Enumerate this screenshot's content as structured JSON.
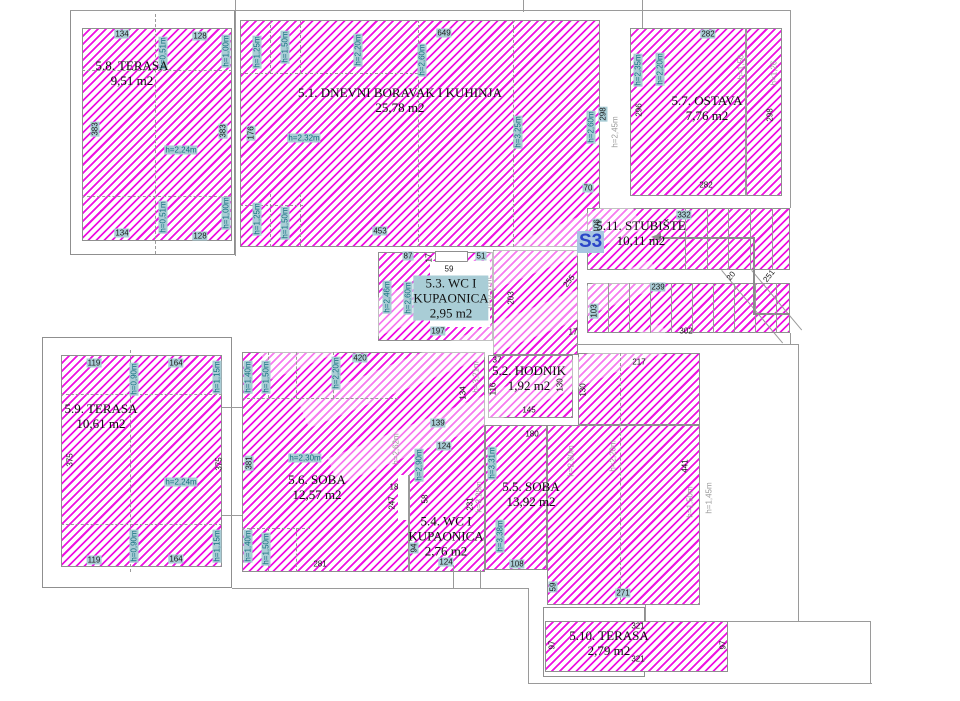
{
  "unit": {
    "label": "S3"
  },
  "palette": {
    "hatch": "#ee10e2",
    "wall": "#9a9a9a",
    "label_bg": "#a9cdd6",
    "height_text": "#15707f",
    "gray_text": "#9b9b9b",
    "s3_text": "#2b46c8",
    "s3_bg": "#a8c6e2"
  },
  "rooms": [
    {
      "lines": [
        "5.8. TERASA",
        "9,51 m2"
      ],
      "cx": 132,
      "cy": 73
    },
    {
      "lines": [
        "5.1. DNEVNI BORAVAK I KUHINJA",
        "25,78 m2"
      ],
      "cx": 400,
      "cy": 100
    },
    {
      "lines": [
        "5.7. OSTAVA",
        "7,76 m2"
      ],
      "cx": 707,
      "cy": 108
    },
    {
      "lines": [
        "5.11. STUBIŠTE",
        "10,11 m2"
      ],
      "cx": 641,
      "cy": 233
    },
    {
      "lines": [
        "5.3. WC I",
        "KUPAONICA",
        "2,95 m2"
      ],
      "cx": 451,
      "cy": 298,
      "bg": true
    },
    {
      "lines": [
        "5.2. HODNIK",
        "1,92 m2"
      ],
      "cx": 529,
      "cy": 378
    },
    {
      "lines": [
        "5.6. SOBA",
        "12,57 m2"
      ],
      "cx": 317,
      "cy": 487
    },
    {
      "lines": [
        "5.4. WC I",
        "KUPAONICA",
        "2,76 m2"
      ],
      "cx": 446,
      "cy": 536
    },
    {
      "lines": [
        "5.5. SOBA",
        "13,92 m2"
      ],
      "cx": 531,
      "cy": 494
    },
    {
      "lines": [
        "5.9. TERASA",
        "10,61 m2"
      ],
      "cx": 101,
      "cy": 416
    },
    {
      "lines": [
        "5.10. TERASA",
        "2,79 m2"
      ],
      "cx": 609,
      "cy": 643
    }
  ],
  "regions": [
    {
      "x": 70,
      "y": 10,
      "w": 165,
      "h": 245,
      "f": "n",
      "b": 1
    },
    {
      "x": 42,
      "y": 337,
      "w": 190,
      "h": 251,
      "f": "n",
      "b": 1
    },
    {
      "x": 543,
      "y": 607,
      "w": 102,
      "h": 70,
      "f": "n",
      "b": 1
    },
    {
      "x": 82,
      "y": 28,
      "w": 150,
      "h": 213,
      "f": "h",
      "b": 1
    },
    {
      "x": 240,
      "y": 20,
      "w": 360,
      "h": 227,
      "f": "h",
      "b": 1
    },
    {
      "x": 630,
      "y": 28,
      "w": 152,
      "h": 168,
      "f": "h",
      "b": 1
    },
    {
      "x": 587,
      "y": 208,
      "w": 203,
      "h": 62,
      "f": "h",
      "b": 1
    },
    {
      "x": 587,
      "y": 283,
      "w": 203,
      "h": 50,
      "f": "h",
      "b": 1
    },
    {
      "x": 378,
      "y": 252,
      "w": 115,
      "h": 89,
      "f": "h",
      "b": 1
    },
    {
      "x": 493,
      "y": 250,
      "w": 85,
      "h": 105,
      "f": "h",
      "b": 1
    },
    {
      "x": 488,
      "y": 355,
      "w": 85,
      "h": 63,
      "f": "h",
      "b": 1
    },
    {
      "x": 578,
      "y": 353,
      "w": 122,
      "h": 72,
      "f": "h",
      "b": 1
    },
    {
      "x": 242,
      "y": 352,
      "w": 243,
      "h": 220,
      "f": "h",
      "b": 1
    },
    {
      "x": 485,
      "y": 425,
      "w": 62,
      "h": 145,
      "f": "h",
      "b": 1
    },
    {
      "x": 547,
      "y": 425,
      "w": 153,
      "h": 180,
      "f": "h",
      "b": 1
    },
    {
      "x": 545,
      "y": 621,
      "w": 183,
      "h": 51,
      "f": "h",
      "b": 1
    },
    {
      "x": 61,
      "y": 355,
      "w": 161,
      "h": 212,
      "f": "h",
      "b": 1
    },
    {
      "x": 430,
      "y": 261,
      "w": 60,
      "h": 66,
      "f": "w",
      "b": 0
    },
    {
      "x": 435,
      "y": 251,
      "w": 33,
      "h": 11,
      "f": "w",
      "b": 1
    },
    {
      "x": 398,
      "y": 475,
      "w": 10,
      "h": 45,
      "f": "w",
      "b": 0
    }
  ],
  "watermarks": [
    {
      "x": 250,
      "y": 270,
      "w": 400,
      "h": 36,
      "r": -22
    },
    {
      "x": 290,
      "y": 330,
      "w": 380,
      "h": 28,
      "r": -22
    },
    {
      "x": 320,
      "y": 390,
      "w": 360,
      "h": 28,
      "r": -22
    }
  ],
  "lines": [
    {
      "o": "h",
      "x": 70,
      "y": 10,
      "l": 720
    },
    {
      "o": "v",
      "x": 235,
      "y": 0,
      "l": 256
    },
    {
      "o": "v",
      "x": 523,
      "y": 0,
      "l": 12
    },
    {
      "o": "v",
      "x": 642,
      "y": 0,
      "l": 28
    },
    {
      "o": "v",
      "x": 790,
      "y": 10,
      "l": 198
    },
    {
      "o": "v",
      "x": 790,
      "y": 333,
      "l": 12
    },
    {
      "o": "h",
      "x": 575,
      "y": 344,
      "l": 223
    },
    {
      "o": "v",
      "x": 798,
      "y": 344,
      "l": 277
    },
    {
      "o": "h",
      "x": 232,
      "y": 588,
      "l": 296
    },
    {
      "o": "v",
      "x": 528,
      "y": 588,
      "l": 96
    },
    {
      "o": "h",
      "x": 528,
      "y": 683,
      "l": 344
    },
    {
      "o": "v",
      "x": 870,
      "y": 621,
      "l": 62
    },
    {
      "o": "h",
      "x": 728,
      "y": 621,
      "l": 142
    },
    {
      "o": "v",
      "x": 453,
      "y": 565,
      "l": 23
    },
    {
      "o": "v",
      "x": 480,
      "y": 570,
      "l": 18
    },
    {
      "o": "v",
      "x": 645,
      "y": 605,
      "l": 16
    },
    {
      "o": "h",
      "x": 222,
      "y": 407,
      "l": 20
    },
    {
      "o": "h",
      "x": 222,
      "y": 515,
      "l": 20
    },
    {
      "o": "v",
      "x": 745,
      "y": 28,
      "l": 168,
      "w": 2
    },
    {
      "o": "v",
      "x": 408,
      "y": 475,
      "l": 97,
      "w": 2
    },
    {
      "o": "h",
      "x": 82,
      "y": 70,
      "l": 150,
      "s": "d"
    },
    {
      "o": "h",
      "x": 82,
      "y": 196,
      "l": 150,
      "s": "d"
    },
    {
      "o": "h",
      "x": 61,
      "y": 394,
      "l": 161,
      "s": "d"
    },
    {
      "o": "h",
      "x": 61,
      "y": 524,
      "l": 161,
      "s": "d"
    },
    {
      "o": "v",
      "x": 418,
      "y": 20,
      "l": 227,
      "s": "d"
    },
    {
      "o": "v",
      "x": 513,
      "y": 20,
      "l": 227,
      "s": "d"
    },
    {
      "o": "v",
      "x": 270,
      "y": 20,
      "l": 53,
      "s": "d"
    },
    {
      "o": "v",
      "x": 300,
      "y": 20,
      "l": 53,
      "s": "d"
    },
    {
      "o": "h",
      "x": 240,
      "y": 73,
      "l": 178,
      "s": "d"
    },
    {
      "o": "h",
      "x": 240,
      "y": 205,
      "l": 63,
      "s": "d"
    },
    {
      "o": "v",
      "x": 270,
      "y": 194,
      "l": 53,
      "s": "d"
    },
    {
      "o": "v",
      "x": 300,
      "y": 194,
      "l": 53,
      "s": "d"
    },
    {
      "o": "h",
      "x": 242,
      "y": 398,
      "l": 156,
      "s": "d"
    },
    {
      "o": "h",
      "x": 242,
      "y": 528,
      "l": 68,
      "s": "d"
    },
    {
      "o": "v",
      "x": 268,
      "y": 352,
      "l": 46,
      "s": "d"
    },
    {
      "o": "v",
      "x": 296,
      "y": 352,
      "l": 46,
      "s": "d"
    },
    {
      "o": "v",
      "x": 333,
      "y": 352,
      "l": 46,
      "s": "d"
    },
    {
      "o": "v",
      "x": 268,
      "y": 528,
      "l": 44,
      "s": "d"
    },
    {
      "o": "v",
      "x": 296,
      "y": 528,
      "l": 44,
      "s": "d"
    },
    {
      "o": "v",
      "x": 620,
      "y": 353,
      "l": 252,
      "s": "d"
    },
    {
      "o": "v",
      "x": 155,
      "y": 14,
      "l": 240,
      "s": "d"
    },
    {
      "o": "v",
      "x": 130,
      "y": 350,
      "l": 222,
      "s": "d"
    },
    {
      "o": "v",
      "x": 685,
      "y": 208,
      "l": 62
    },
    {
      "o": "v",
      "x": 707,
      "y": 208,
      "l": 62
    },
    {
      "o": "v",
      "x": 728,
      "y": 208,
      "l": 62
    },
    {
      "o": "v",
      "x": 750,
      "y": 208,
      "l": 62
    },
    {
      "o": "v",
      "x": 772,
      "y": 208,
      "l": 62
    },
    {
      "o": "v",
      "x": 608,
      "y": 283,
      "l": 50
    },
    {
      "o": "v",
      "x": 629,
      "y": 283,
      "l": 50
    },
    {
      "o": "v",
      "x": 650,
      "y": 283,
      "l": 50
    },
    {
      "o": "v",
      "x": 671,
      "y": 283,
      "l": 50
    },
    {
      "o": "v",
      "x": 692,
      "y": 283,
      "l": 50
    },
    {
      "o": "v",
      "x": 713,
      "y": 283,
      "l": 50
    },
    {
      "o": "v",
      "x": 734,
      "y": 283,
      "l": 50
    },
    {
      "o": "v",
      "x": 755,
      "y": 283,
      "l": 50
    },
    {
      "o": "v",
      "x": 776,
      "y": 283,
      "l": 50
    },
    {
      "o": "h",
      "x": 722,
      "y": 270,
      "l": 95,
      "r": 50
    },
    {
      "o": "h",
      "x": 752,
      "y": 270,
      "l": 78,
      "r": 50
    },
    {
      "o": "h",
      "x": 662,
      "y": 237,
      "l": 91,
      "w": 2,
      "c": "#8c8c8c"
    },
    {
      "o": "v",
      "x": 753,
      "y": 237,
      "l": 76,
      "w": 2,
      "c": "#8c8c8c"
    },
    {
      "o": "h",
      "x": 753,
      "y": 313,
      "l": 37,
      "w": 2,
      "c": "#8c8c8c"
    }
  ],
  "arrow": {
    "x": 651,
    "y": 233
  },
  "dimensions": [
    {
      "t": "134",
      "x": 122,
      "y": 34,
      "k": "d"
    },
    {
      "t": "128",
      "x": 200,
      "y": 36,
      "k": "d"
    },
    {
      "t": "h=0,51m",
      "x": 163,
      "y": 53,
      "k": "h",
      "r": -90
    },
    {
      "t": "h=1,00m",
      "x": 226,
      "y": 51,
      "k": "h",
      "r": -90
    },
    {
      "t": "383",
      "x": 95,
      "y": 129,
      "k": "d",
      "r": -90
    },
    {
      "t": "383",
      "x": 223,
      "y": 131,
      "k": "d",
      "r": -90
    },
    {
      "t": "h=2,24m",
      "x": 181,
      "y": 150,
      "k": "h"
    },
    {
      "t": "134",
      "x": 122,
      "y": 233,
      "k": "d"
    },
    {
      "t": "128",
      "x": 200,
      "y": 236,
      "k": "d"
    },
    {
      "t": "h=0,51m",
      "x": 163,
      "y": 217,
      "k": "h",
      "r": -90
    },
    {
      "t": "h=1,00m",
      "x": 226,
      "y": 213,
      "k": "h",
      "r": -90
    },
    {
      "t": "h=1,25m",
      "x": 257,
      "y": 52,
      "k": "h",
      "r": -90
    },
    {
      "t": "h=1,50m",
      "x": 285,
      "y": 47,
      "k": "h",
      "r": -90
    },
    {
      "t": "h=2,20m",
      "x": 358,
      "y": 50,
      "k": "h",
      "r": -90
    },
    {
      "t": "h=2,60m",
      "x": 422,
      "y": 60,
      "k": "h",
      "r": -90
    },
    {
      "t": "649",
      "x": 444,
      "y": 33,
      "k": "d"
    },
    {
      "t": "176",
      "x": 251,
      "y": 133,
      "k": "d",
      "r": -90
    },
    {
      "t": "h=2,32m",
      "x": 304,
      "y": 138,
      "k": "h"
    },
    {
      "t": "h=3,25m",
      "x": 518,
      "y": 132,
      "k": "h",
      "r": -90
    },
    {
      "t": "h=2,60m",
      "x": 591,
      "y": 127,
      "k": "h",
      "r": -90
    },
    {
      "t": "298",
      "x": 603,
      "y": 114,
      "k": "d",
      "r": -90
    },
    {
      "t": "h=2,45m",
      "x": 615,
      "y": 132,
      "k": "g",
      "r": -90
    },
    {
      "t": "70",
      "x": 588,
      "y": 188,
      "k": "d"
    },
    {
      "t": "h=1,25m",
      "x": 257,
      "y": 219,
      "k": "h",
      "r": -90
    },
    {
      "t": "h=1,50m",
      "x": 285,
      "y": 223,
      "k": "h",
      "r": -90
    },
    {
      "t": "453",
      "x": 380,
      "y": 231,
      "k": "d"
    },
    {
      "t": "282",
      "x": 708,
      "y": 34,
      "k": "d"
    },
    {
      "t": "h=2,35m",
      "x": 638,
      "y": 70,
      "k": "h",
      "r": -90
    },
    {
      "t": "h=2,20m",
      "x": 660,
      "y": 69,
      "k": "h",
      "r": -90
    },
    {
      "t": "296",
      "x": 639,
      "y": 110,
      "k": "p",
      "r": -90
    },
    {
      "t": "h=1,50",
      "x": 741,
      "y": 67,
      "k": "g",
      "r": -90
    },
    {
      "t": "h=1,26",
      "x": 774,
      "y": 73,
      "k": "g",
      "r": -90
    },
    {
      "t": "298",
      "x": 770,
      "y": 115,
      "k": "p",
      "r": -90
    },
    {
      "t": "282",
      "x": 706,
      "y": 185,
      "k": "p"
    },
    {
      "t": "332",
      "x": 684,
      "y": 215,
      "k": "d"
    },
    {
      "t": "106",
      "x": 597,
      "y": 226,
      "k": "d",
      "r": -90
    },
    {
      "t": "239",
      "x": 658,
      "y": 287,
      "k": "d"
    },
    {
      "t": "103",
      "x": 594,
      "y": 311,
      "k": "d",
      "r": -90
    },
    {
      "t": "302",
      "x": 686,
      "y": 331,
      "k": "p"
    },
    {
      "t": "20",
      "x": 731,
      "y": 276,
      "k": "p",
      "r": -52
    },
    {
      "t": "251",
      "x": 769,
      "y": 276,
      "k": "p",
      "r": -52
    },
    {
      "t": "87",
      "x": 408,
      "y": 256,
      "k": "d"
    },
    {
      "t": "17",
      "x": 429,
      "y": 258,
      "k": "p",
      "r": -90
    },
    {
      "t": "51",
      "x": 481,
      "y": 256,
      "k": "d"
    },
    {
      "t": "59",
      "x": 449,
      "y": 269,
      "k": "p"
    },
    {
      "t": "h=2,46m",
      "x": 387,
      "y": 297,
      "k": "h",
      "r": -90
    },
    {
      "t": "h=2,60m",
      "x": 408,
      "y": 298,
      "k": "h",
      "r": -90
    },
    {
      "t": "197",
      "x": 438,
      "y": 331,
      "k": "d"
    },
    {
      "t": "h=0,37m",
      "x": 489,
      "y": 293,
      "k": "g",
      "r": -90
    },
    {
      "t": "203",
      "x": 511,
      "y": 298,
      "k": "p",
      "r": -90
    },
    {
      "t": "255",
      "x": 569,
      "y": 281,
      "k": "p",
      "r": -52
    },
    {
      "t": "17",
      "x": 573,
      "y": 332,
      "k": "p"
    },
    {
      "t": "37",
      "x": 497,
      "y": 360,
      "k": "p"
    },
    {
      "t": "116",
      "x": 493,
      "y": 389,
      "k": "p",
      "r": -90
    },
    {
      "t": "130",
      "x": 560,
      "y": 385,
      "k": "p",
      "r": -90
    },
    {
      "t": "130",
      "x": 583,
      "y": 390,
      "k": "p",
      "r": -90
    },
    {
      "t": "145",
      "x": 529,
      "y": 410,
      "k": "p"
    },
    {
      "t": "h=3,21m",
      "x": 476,
      "y": 377,
      "k": "g",
      "r": -90
    },
    {
      "t": "217",
      "x": 639,
      "y": 362,
      "k": "p"
    },
    {
      "t": "180",
      "x": 532,
      "y": 434,
      "k": "p"
    },
    {
      "t": "420",
      "x": 360,
      "y": 358,
      "k": "d"
    },
    {
      "t": "h=1,40m",
      "x": 248,
      "y": 377,
      "k": "h",
      "r": -90
    },
    {
      "t": "h=1,50m",
      "x": 266,
      "y": 377,
      "k": "h",
      "r": -90
    },
    {
      "t": "h=2,20m",
      "x": 336,
      "y": 373,
      "k": "h",
      "r": -90
    },
    {
      "t": "381",
      "x": 249,
      "y": 463,
      "k": "d",
      "r": -90
    },
    {
      "t": "h=2,30m",
      "x": 305,
      "y": 458,
      "k": "h"
    },
    {
      "t": "h=2,62m",
      "x": 396,
      "y": 449,
      "k": "g",
      "r": -90
    },
    {
      "t": "247",
      "x": 392,
      "y": 503,
      "k": "p",
      "r": -90
    },
    {
      "t": "h=1,40m",
      "x": 248,
      "y": 546,
      "k": "h",
      "r": -90
    },
    {
      "t": "h=1,50m",
      "x": 266,
      "y": 549,
      "k": "h",
      "r": -90
    },
    {
      "t": "281",
      "x": 320,
      "y": 564,
      "k": "p"
    },
    {
      "t": "139",
      "x": 438,
      "y": 423,
      "k": "d"
    },
    {
      "t": "124",
      "x": 444,
      "y": 446,
      "k": "d"
    },
    {
      "t": "134",
      "x": 463,
      "y": 393,
      "k": "p",
      "r": -90
    },
    {
      "t": "h=2,90m",
      "x": 419,
      "y": 465,
      "k": "h",
      "r": -90
    },
    {
      "t": "18",
      "x": 394,
      "y": 487,
      "k": "p"
    },
    {
      "t": "58",
      "x": 425,
      "y": 499,
      "k": "p",
      "r": -90
    },
    {
      "t": "231",
      "x": 470,
      "y": 504,
      "k": "p",
      "r": -90
    },
    {
      "t": "h=3,28m",
      "x": 479,
      "y": 497,
      "k": "g",
      "r": -90
    },
    {
      "t": "94",
      "x": 414,
      "y": 548,
      "k": "d",
      "r": -90
    },
    {
      "t": "124",
      "x": 446,
      "y": 562,
      "k": "d"
    },
    {
      "t": "h=3,31m",
      "x": 492,
      "y": 463,
      "k": "h",
      "r": -90
    },
    {
      "t": "h=3,38m",
      "x": 500,
      "y": 536,
      "k": "h",
      "r": -90
    },
    {
      "t": "h=2,60m",
      "x": 571,
      "y": 461,
      "k": "g",
      "r": -90
    },
    {
      "t": "h=2,20m",
      "x": 613,
      "y": 456,
      "k": "g",
      "r": -90
    },
    {
      "t": "441",
      "x": 685,
      "y": 466,
      "k": "p",
      "r": -90
    },
    {
      "t": "h=1,50m",
      "x": 690,
      "y": 502,
      "k": "g",
      "r": -90
    },
    {
      "t": "h=1,45m",
      "x": 709,
      "y": 498,
      "k": "g",
      "r": -90
    },
    {
      "t": "108",
      "x": 517,
      "y": 564,
      "k": "d"
    },
    {
      "t": "59",
      "x": 553,
      "y": 587,
      "k": "d",
      "r": -90
    },
    {
      "t": "271",
      "x": 623,
      "y": 593,
      "k": "d"
    },
    {
      "t": "119",
      "x": 94,
      "y": 363,
      "k": "d"
    },
    {
      "t": "164",
      "x": 176,
      "y": 363,
      "k": "d"
    },
    {
      "t": "h=0,90m",
      "x": 134,
      "y": 379,
      "k": "h",
      "r": -90
    },
    {
      "t": "h=1,15m",
      "x": 217,
      "y": 377,
      "k": "h",
      "r": -90
    },
    {
      "t": "375",
      "x": 70,
      "y": 460,
      "k": "p",
      "r": -90
    },
    {
      "t": "375",
      "x": 219,
      "y": 464,
      "k": "p",
      "r": -90
    },
    {
      "t": "h=2,24m",
      "x": 181,
      "y": 482,
      "k": "h"
    },
    {
      "t": "119",
      "x": 94,
      "y": 560,
      "k": "d"
    },
    {
      "t": "164",
      "x": 176,
      "y": 559,
      "k": "d"
    },
    {
      "t": "h=0,90m",
      "x": 134,
      "y": 546,
      "k": "h",
      "r": -90
    },
    {
      "t": "h=1,15m",
      "x": 217,
      "y": 546,
      "k": "h",
      "r": -90
    },
    {
      "t": "321",
      "x": 638,
      "y": 626,
      "k": "p"
    },
    {
      "t": "321",
      "x": 638,
      "y": 659,
      "k": "p"
    },
    {
      "t": "97",
      "x": 552,
      "y": 645,
      "k": "p",
      "r": -90
    },
    {
      "t": "97",
      "x": 723,
      "y": 645,
      "k": "p",
      "r": -90
    }
  ]
}
